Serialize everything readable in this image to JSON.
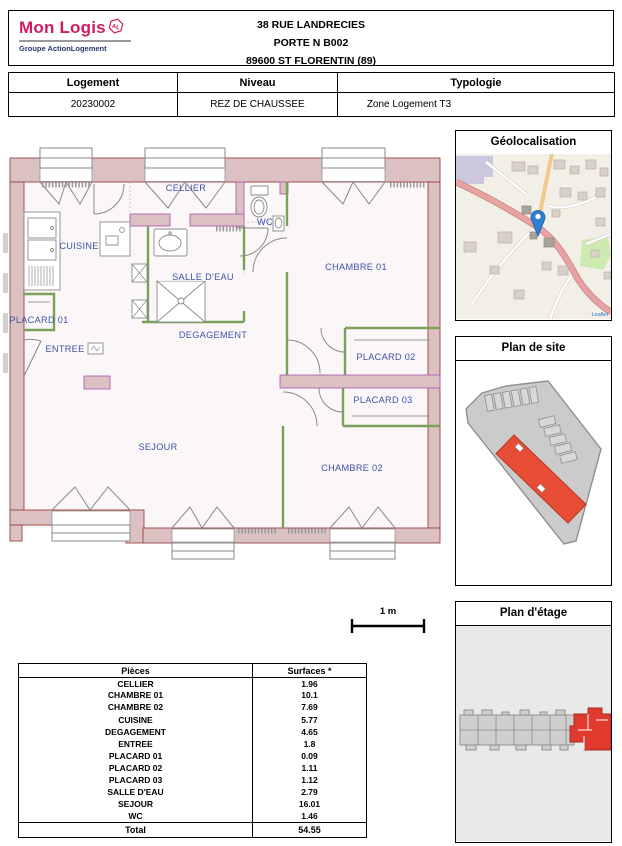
{
  "header": {
    "logo": {
      "brand": "Mon Logis",
      "badge": "AL",
      "tagline": "Groupe ActionLogement"
    },
    "address_lines": [
      "38 RUE LANDRECIES",
      "PORTE N B002",
      "89600 ST FLORENTIN (89)"
    ]
  },
  "info_table": {
    "headers": [
      "Logement",
      "Niveau",
      "Typologie"
    ],
    "values": [
      "20230002",
      "REZ DE CHAUSSEE",
      "Zone Logement T3"
    ]
  },
  "floor_plan": {
    "rooms": [
      "CELLIER",
      "WC",
      "CUISINE",
      "CHAMBRE 01",
      "SALLE D'EAU",
      "PLACARD 01",
      "DEGAGEMENT",
      "ENTREE",
      "PLACARD 02",
      "PLACARD 03",
      "SEJOUR",
      "CHAMBRE 02"
    ],
    "scale_label": "1 m"
  },
  "panels": {
    "geolocalisation": {
      "title": "Géolocalisation",
      "attribution": "Leaflet"
    },
    "plan_de_site": {
      "title": "Plan de site"
    },
    "plan_etage": {
      "title": "Plan d'étage"
    }
  },
  "surfaces_table": {
    "headers": [
      "Pièces",
      "Surfaces *"
    ],
    "rows": [
      [
        "CELLIER",
        "1.96"
      ],
      [
        "CHAMBRE 01",
        "10.1"
      ],
      [
        "CHAMBRE 02",
        "7.69"
      ],
      [
        "CUISINE",
        "5.77"
      ],
      [
        "DEGAGEMENT",
        "4.65"
      ],
      [
        "ENTREE",
        "1.8"
      ],
      [
        "PLACARD 01",
        "0.09"
      ],
      [
        "PLACARD 02",
        "1.11"
      ],
      [
        "PLACARD 03",
        "1.12"
      ],
      [
        "SALLE D'EAU",
        "2.79"
      ],
      [
        "SEJOUR",
        "16.01"
      ],
      [
        "WC",
        "1.46"
      ]
    ],
    "total_label": "Total",
    "total_value": "54.55"
  },
  "colors": {
    "brand_pink": "#cf1d5f",
    "brand_navy": "#25386e",
    "room_label_blue": "#3d53a8",
    "wall_pink": "#dcc1c3",
    "highlight_red": "#e0392e"
  }
}
